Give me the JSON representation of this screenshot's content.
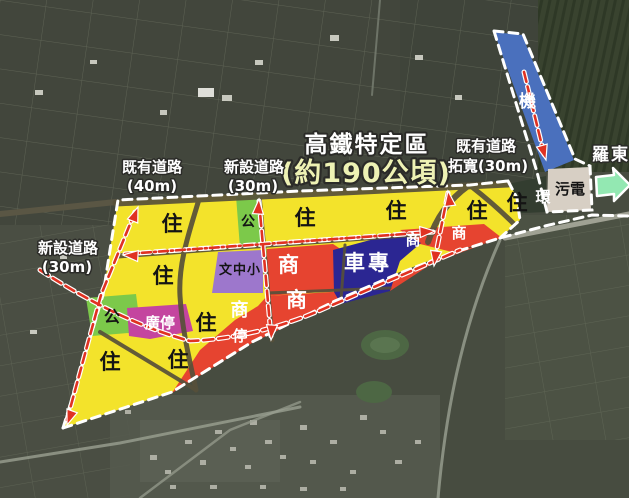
{
  "title": {
    "line1": "高鐵特定區",
    "line2": "(約190公頃)"
  },
  "road_labels": [
    {
      "id": "existing-40m",
      "line1": "既有道路",
      "line2": "(40m)"
    },
    {
      "id": "new-30m-top",
      "line1": "新設道路",
      "line2": "(30m)"
    },
    {
      "id": "existing-widened-30m",
      "line1": "既有道路",
      "line2": "拓寬(30m)"
    },
    {
      "id": "new-30m-west",
      "line1": "新設道路",
      "line2": "(30m)"
    }
  ],
  "direction_label": "羅東",
  "zones": [
    {
      "glyph": "住",
      "use": "residential",
      "color": "#f3e32b",
      "label_count": 9
    },
    {
      "glyph": "商",
      "use": "commercial",
      "color": "#e64430",
      "label_count": 5
    },
    {
      "glyph": "公",
      "use": "park",
      "color": "#7cc94a",
      "label_count": 2
    },
    {
      "glyph": "文中小",
      "use": "school",
      "color": "#9d77cc",
      "label_count": 1
    },
    {
      "glyph": "廣停",
      "use": "plaza-parking",
      "color": "#c4459f",
      "label_count": 1
    },
    {
      "glyph": "停",
      "use": "parking-strip",
      "color": "#e64430",
      "label_count": 1
    },
    {
      "glyph": "車專",
      "use": "vehicle-depot",
      "color": "#2b2692",
      "label_count": 1
    },
    {
      "glyph": "機",
      "use": "rail-depot-strip",
      "color": "#4a70bd",
      "label_count": 1
    },
    {
      "glyph": "污電",
      "use": "sewage-power",
      "color": "#d7cfc4",
      "label_count": 1
    },
    {
      "glyph": "環",
      "use": "environmental",
      "color": "#ffffff",
      "label_count": 1
    }
  ],
  "colors": {
    "boundary_dash": "#ffffff",
    "annotation_dash": "#e03222",
    "direction_arrow": "#93e8b2",
    "title_line2": "#eef2b4"
  }
}
